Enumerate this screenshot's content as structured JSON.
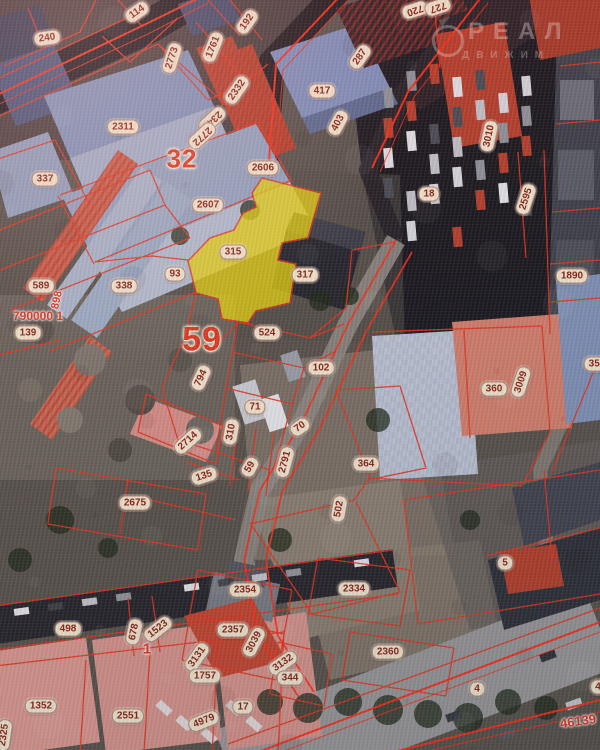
{
  "watermark": {
    "line1": "РЕАЛ",
    "line2": "ДВИЖИМ"
  },
  "colors": {
    "boundary_red": "#e8351f",
    "bright_red": "#ff2d18",
    "highlight_yellow": "#e9d70e",
    "label_bg": "#f4ecd4",
    "label_text": "#8b2418",
    "quarter_red": "#e03a22"
  },
  "highlighted_parcel": {
    "number": "315"
  },
  "quarter_numbers": [
    "32",
    "59"
  ],
  "labels": [
    {
      "t": "240",
      "x": 47,
      "y": 38,
      "r": -8,
      "k": "pill"
    },
    {
      "t": "114",
      "x": 137,
      "y": 12,
      "r": -35,
      "k": "pill"
    },
    {
      "t": "192",
      "x": 247,
      "y": 22,
      "r": -55,
      "k": "pill"
    },
    {
      "t": "1761",
      "x": 213,
      "y": 47,
      "r": -68,
      "k": "pill"
    },
    {
      "t": "2773",
      "x": 172,
      "y": 58,
      "r": -72,
      "k": "pill"
    },
    {
      "t": "2332",
      "x": 237,
      "y": 90,
      "r": -55,
      "k": "pill"
    },
    {
      "t": "2340",
      "x": 212,
      "y": 120,
      "r": 137,
      "k": "pill"
    },
    {
      "t": "2772",
      "x": 202,
      "y": 136,
      "r": 137,
      "k": "pill"
    },
    {
      "t": "2311",
      "x": 123,
      "y": 127,
      "r": 0,
      "k": "pill"
    },
    {
      "t": "287",
      "x": 360,
      "y": 57,
      "r": -55,
      "k": "pill"
    },
    {
      "t": "417",
      "x": 322,
      "y": 91,
      "r": 0,
      "k": "pill"
    },
    {
      "t": "403",
      "x": 338,
      "y": 123,
      "r": -62,
      "k": "pill"
    },
    {
      "t": "720",
      "x": 415,
      "y": 10,
      "r": 162,
      "k": "pill"
    },
    {
      "t": "727",
      "x": 438,
      "y": 7,
      "r": 162,
      "k": "pill"
    },
    {
      "t": "3010",
      "x": 489,
      "y": 136,
      "r": -78,
      "k": "pill"
    },
    {
      "t": "18",
      "x": 429,
      "y": 194,
      "r": 0,
      "k": "pill"
    },
    {
      "t": "2595",
      "x": 526,
      "y": 199,
      "r": -72,
      "k": "pill"
    },
    {
      "t": "1890",
      "x": 572,
      "y": 276,
      "r": 0,
      "k": "pill"
    },
    {
      "t": "337",
      "x": 45,
      "y": 179,
      "r": 0,
      "k": "pill"
    },
    {
      "t": "32",
      "x": 182,
      "y": 159,
      "r": 0,
      "k": "big",
      "s": 26
    },
    {
      "t": "2606",
      "x": 263,
      "y": 168,
      "r": 0,
      "k": "pill"
    },
    {
      "t": "2607",
      "x": 208,
      "y": 205,
      "r": 0,
      "k": "pill"
    },
    {
      "t": "589",
      "x": 41,
      "y": 286,
      "r": 0,
      "k": "pill"
    },
    {
      "t": "338",
      "x": 124,
      "y": 286,
      "r": 0,
      "k": "pill"
    },
    {
      "t": "93",
      "x": 175,
      "y": 274,
      "r": 0,
      "k": "pill"
    },
    {
      "t": "315",
      "x": 233,
      "y": 252,
      "r": 0,
      "k": "pill"
    },
    {
      "t": "317",
      "x": 305,
      "y": 275,
      "r": 0,
      "k": "pill"
    },
    {
      "t": "790000 1",
      "x": 38,
      "y": 316,
      "r": 0,
      "k": "red",
      "s": 12
    },
    {
      "t": "898",
      "x": 57,
      "y": 300,
      "r": -78,
      "k": "red",
      "s": 11
    },
    {
      "t": "139",
      "x": 28,
      "y": 333,
      "r": 0,
      "k": "pill"
    },
    {
      "t": "59",
      "x": 202,
      "y": 340,
      "r": 0,
      "k": "big",
      "s": 34
    },
    {
      "t": "794",
      "x": 201,
      "y": 378,
      "r": -65,
      "k": "pill"
    },
    {
      "t": "524",
      "x": 267,
      "y": 333,
      "r": 0,
      "k": "pill"
    },
    {
      "t": "102",
      "x": 321,
      "y": 368,
      "r": 0,
      "k": "pill"
    },
    {
      "t": "71",
      "x": 255,
      "y": 407,
      "r": 0,
      "k": "pill"
    },
    {
      "t": "70",
      "x": 300,
      "y": 427,
      "r": -35,
      "k": "pill"
    },
    {
      "t": "310",
      "x": 231,
      "y": 432,
      "r": -80,
      "k": "pill"
    },
    {
      "t": "2714",
      "x": 188,
      "y": 441,
      "r": -42,
      "k": "pill"
    },
    {
      "t": "59",
      "x": 250,
      "y": 467,
      "r": -60,
      "k": "pill"
    },
    {
      "t": "2791",
      "x": 285,
      "y": 462,
      "r": -75,
      "k": "pill"
    },
    {
      "t": "135",
      "x": 204,
      "y": 476,
      "r": -18,
      "k": "pill"
    },
    {
      "t": "364",
      "x": 366,
      "y": 464,
      "r": 0,
      "k": "pill"
    },
    {
      "t": "360",
      "x": 494,
      "y": 389,
      "r": 0,
      "k": "pill"
    },
    {
      "t": "3009",
      "x": 521,
      "y": 382,
      "r": -72,
      "k": "pill"
    },
    {
      "t": "355",
      "x": 597,
      "y": 364,
      "r": 0,
      "k": "pill"
    },
    {
      "t": "2675",
      "x": 135,
      "y": 503,
      "r": 0,
      "k": "pill"
    },
    {
      "t": "502",
      "x": 339,
      "y": 509,
      "r": -80,
      "k": "pill"
    },
    {
      "t": "5",
      "x": 505,
      "y": 563,
      "r": 0,
      "k": "pill"
    },
    {
      "t": "2354",
      "x": 245,
      "y": 590,
      "r": 0,
      "k": "pill"
    },
    {
      "t": "2334",
      "x": 354,
      "y": 589,
      "r": 0,
      "k": "pill"
    },
    {
      "t": "2357",
      "x": 233,
      "y": 630,
      "r": 0,
      "k": "pill"
    },
    {
      "t": "3039",
      "x": 254,
      "y": 642,
      "r": -62,
      "k": "pill"
    },
    {
      "t": "2360",
      "x": 388,
      "y": 652,
      "r": 0,
      "k": "pill"
    },
    {
      "t": "3132",
      "x": 283,
      "y": 663,
      "r": -35,
      "k": "pill"
    },
    {
      "t": "344",
      "x": 290,
      "y": 678,
      "r": 0,
      "k": "pill"
    },
    {
      "t": "3131",
      "x": 197,
      "y": 657,
      "r": -55,
      "k": "pill"
    },
    {
      "t": "1757",
      "x": 205,
      "y": 676,
      "r": 0,
      "k": "pill"
    },
    {
      "t": "1",
      "x": 147,
      "y": 649,
      "r": 0,
      "k": "red",
      "s": 15
    },
    {
      "t": "498",
      "x": 68,
      "y": 629,
      "r": 0,
      "k": "pill"
    },
    {
      "t": "678",
      "x": 134,
      "y": 632,
      "r": -78,
      "k": "pill"
    },
    {
      "t": "1523",
      "x": 158,
      "y": 629,
      "r": -38,
      "k": "pill"
    },
    {
      "t": "1352",
      "x": 41,
      "y": 706,
      "r": 0,
      "k": "pill"
    },
    {
      "t": "2551",
      "x": 128,
      "y": 716,
      "r": 0,
      "k": "pill"
    },
    {
      "t": "4979",
      "x": 204,
      "y": 721,
      "r": -22,
      "k": "pill"
    },
    {
      "t": "17",
      "x": 243,
      "y": 707,
      "r": 0,
      "k": "pill"
    },
    {
      "t": "2325",
      "x": 4,
      "y": 735,
      "r": -82,
      "k": "pill"
    },
    {
      "t": "46139",
      "x": 578,
      "y": 721,
      "r": -8,
      "k": "red",
      "s": 13
    },
    {
      "t": "4",
      "x": 477,
      "y": 689,
      "r": 0,
      "k": "pill"
    },
    {
      "t": "4",
      "x": 598,
      "y": 687,
      "r": 0,
      "k": "pill"
    }
  ]
}
